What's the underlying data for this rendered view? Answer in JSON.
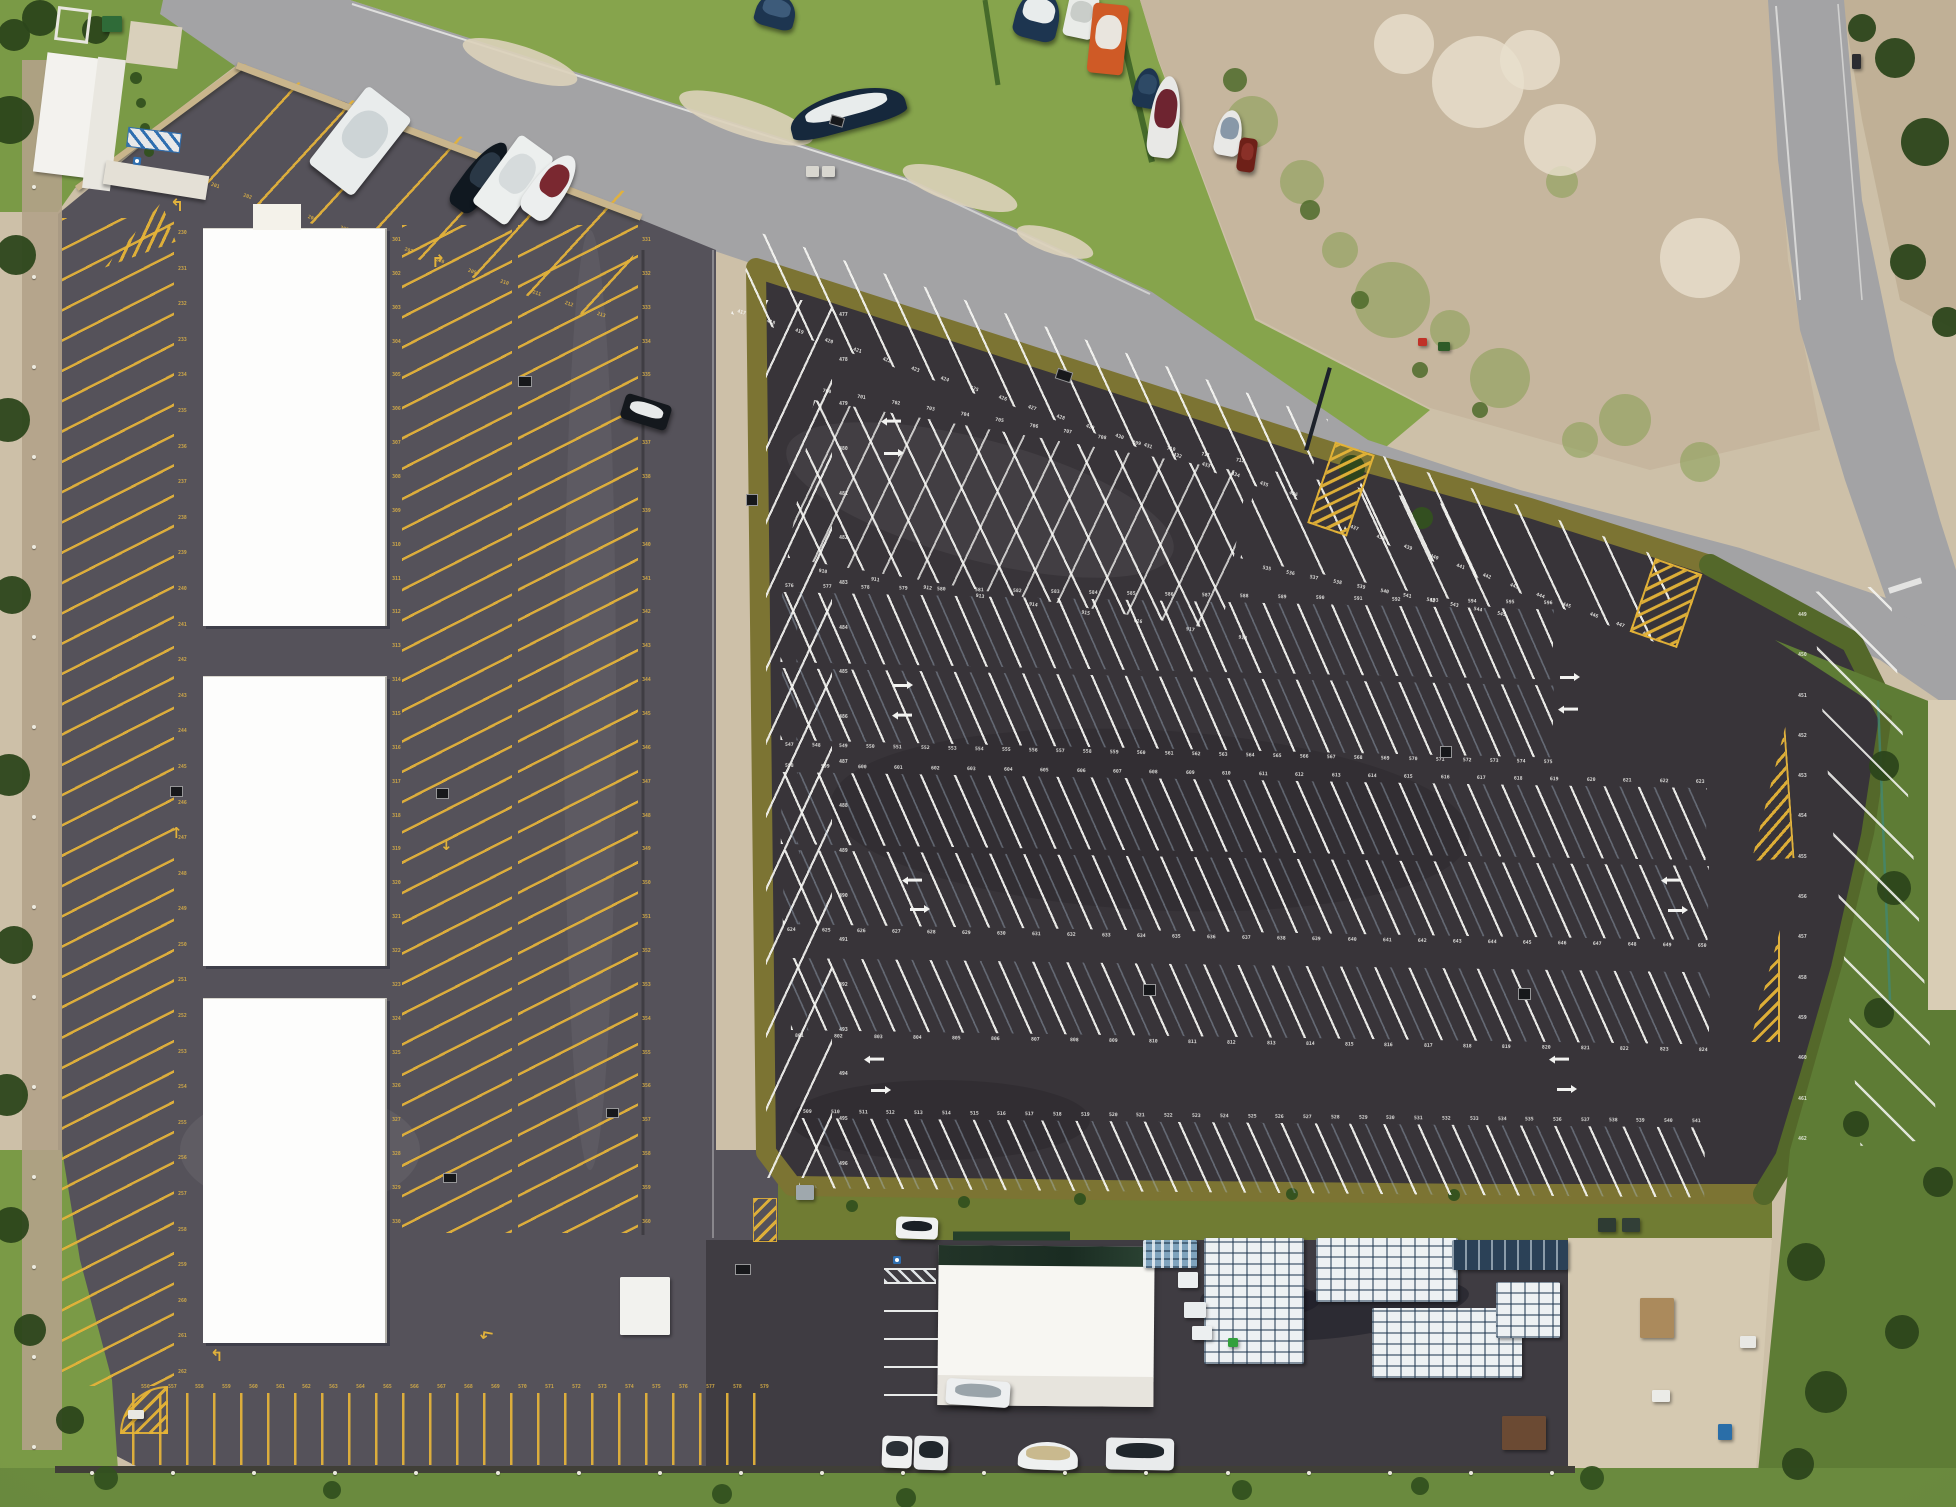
{
  "meta": {
    "title": "Aerial top-down drone photo of a marina parking complex",
    "width": 1956,
    "height": 1507,
    "scene": "New dark-asphalt trailer parking lot with white numbered stalls, older gray lot with yellow stalls and three white storage canopies, access roads, boat yard, dirt lot, warehouse with pallet yard"
  },
  "palette": {
    "sand": "#cdc0a8",
    "dirt": "#c6b69e",
    "road": "#a3a3a5",
    "left_lot": "#55525a",
    "main_lot": "#383439",
    "yard": "#3f3c42",
    "berm_olive": "#7c7433",
    "berm_green": "#54682a",
    "grass": "#7a9a46",
    "grass_dark": "#5e7c35",
    "yellow_paint": "#e3b23c",
    "white_paint": "#f2f2f0",
    "canopy_white": "#fdfdfc",
    "wall_tan": "#c9b58c",
    "blue_paint": "#2f6fb0"
  },
  "space_numbers": {
    "rv_spaces": {
      "start": 201,
      "end": 213
    },
    "left_col1": {
      "start": 230,
      "end": 262
    },
    "left_col2": {
      "start": 301,
      "end": 330
    },
    "left_col3": {
      "start": 331,
      "end": 360
    },
    "bottom_drive": {
      "start": 556,
      "end": 579
    },
    "top_edge": {
      "start": 417,
      "end": 436
    },
    "top_edge_right": {
      "start": 437,
      "end": 448
    },
    "left_col_main": {
      "start": 477,
      "end": 496
    },
    "right_col_main": {
      "start": 449,
      "end": 462
    },
    "cross_upper": {
      "start": 700,
      "end": 712
    },
    "cross_lower": {
      "start": 910,
      "end": 918
    },
    "rowA": {
      "start": 535,
      "end": 545
    },
    "r1_top": {
      "start": 576,
      "end": 596
    },
    "r1_bottom": {
      "start": 547,
      "end": 575
    },
    "r2_top": {
      "start": 598,
      "end": 623
    },
    "r2_bottom": {
      "start": 624,
      "end": 650
    },
    "r3_bottom": {
      "start": 801,
      "end": 824
    },
    "r4_top": {
      "start": 509,
      "end": 541
    }
  },
  "markings": {
    "white_arrows": [
      [
        886,
        420,
        180
      ],
      [
        884,
        452,
        0
      ],
      [
        893,
        684,
        0
      ],
      [
        897,
        714,
        180
      ],
      [
        907,
        879,
        180
      ],
      [
        910,
        908,
        0
      ],
      [
        869,
        1058,
        180
      ],
      [
        871,
        1089,
        0
      ],
      [
        1560,
        676,
        0
      ],
      [
        1563,
        708,
        180
      ],
      [
        1666,
        879,
        180
      ],
      [
        1668,
        909,
        0
      ],
      [
        1554,
        1058,
        180
      ],
      [
        1557,
        1088,
        0
      ]
    ],
    "yellow_arrows": [
      [
        170,
        196,
        "↰",
        0,
        17
      ],
      [
        431,
        252,
        "↱",
        0,
        17
      ],
      [
        170,
        824,
        "↑",
        0,
        15
      ],
      [
        440,
        836,
        "↓",
        0,
        15
      ],
      [
        210,
        1346,
        "↰",
        0,
        16
      ],
      [
        480,
        1326,
        "↰",
        -80,
        16
      ]
    ]
  },
  "objects": {
    "vehicles": [
      {
        "x": 756,
        "y": -6,
        "w": 40,
        "h": 34,
        "r": 15,
        "c1": "#1d3550",
        "c2": "#3d5b7a",
        "n": "boat"
      },
      {
        "x": 788,
        "y": 92,
        "w": 118,
        "h": 38,
        "r": -15,
        "c1": "#16283c",
        "c2": "#e8ecec",
        "n": "boat"
      },
      {
        "x": 1016,
        "y": -10,
        "w": 44,
        "h": 50,
        "r": 14,
        "c1": "#1d3550",
        "c2": "#e8ecec",
        "n": "boat"
      },
      {
        "x": 1066,
        "y": -6,
        "w": 30,
        "h": 44,
        "r": 12,
        "c1": "#e9ebe8",
        "c2": "#c9cdc9",
        "n": "camper"
      },
      {
        "x": 1090,
        "y": 4,
        "w": 36,
        "h": 70,
        "r": 6,
        "c1": "#cf5a26",
        "c2": "#e9e5de",
        "n": "truck-orange"
      },
      {
        "x": 1134,
        "y": 68,
        "w": 26,
        "h": 40,
        "r": 10,
        "c1": "#1d3550",
        "c2": "#2e4a66",
        "n": "boat"
      },
      {
        "x": 1150,
        "y": 76,
        "w": 30,
        "h": 82,
        "r": 7,
        "c1": "#e8e8e6",
        "c2": "#6e2430",
        "n": "boat-maroon"
      },
      {
        "x": 1216,
        "y": 110,
        "w": 26,
        "h": 46,
        "r": 10,
        "c1": "#e8e8e6",
        "c2": "#8898a8",
        "n": "boat"
      },
      {
        "x": 1238,
        "y": 138,
        "w": 18,
        "h": 34,
        "r": 8,
        "c1": "#6e2018",
        "c2": "#8a3028",
        "n": "car-red"
      },
      {
        "x": 332,
        "y": 92,
        "w": 56,
        "h": 98,
        "r": 38,
        "c1": "#e9ecec",
        "c2": "#cdd4d6",
        "n": "rv-bus"
      },
      {
        "x": 466,
        "y": 136,
        "w": 30,
        "h": 80,
        "r": 36,
        "c1": "#101820",
        "c2": "#2a3846",
        "n": "boat-black"
      },
      {
        "x": 492,
        "y": 138,
        "w": 42,
        "h": 84,
        "r": 36,
        "c1": "#ecefee",
        "c2": "#d6dbdc",
        "n": "rv"
      },
      {
        "x": 534,
        "y": 150,
        "w": 34,
        "h": 72,
        "r": 36,
        "c1": "#eceeee",
        "c2": "#7a2830",
        "n": "boat-maroon"
      },
      {
        "x": 622,
        "y": 399,
        "w": 48,
        "h": 26,
        "r": 17,
        "c1": "#14181d",
        "c2": "#e8eaea",
        "n": "car-black"
      },
      {
        "x": 896,
        "y": 1217,
        "w": 42,
        "h": 22,
        "r": 2,
        "c1": "#eff1f1",
        "c2": "#1a2026",
        "n": "car-white"
      },
      {
        "x": 946,
        "y": 1380,
        "w": 64,
        "h": 26,
        "r": 4,
        "c1": "#edeff0",
        "c2": "#9aa4aa",
        "n": "truck-trailer"
      },
      {
        "x": 882,
        "y": 1436,
        "w": 30,
        "h": 32,
        "r": 2,
        "c1": "#eef0f0",
        "c2": "#2a3036",
        "n": "car-white"
      },
      {
        "x": 914,
        "y": 1436,
        "w": 34,
        "h": 34,
        "r": 2,
        "c1": "#e9ebec",
        "c2": "#20262c",
        "n": "car-white"
      },
      {
        "x": 1018,
        "y": 1442,
        "w": 60,
        "h": 28,
        "r": 2,
        "c1": "#eef0f0",
        "c2": "#c9b98e",
        "n": "truck-boat"
      },
      {
        "x": 1106,
        "y": 1438,
        "w": 68,
        "h": 32,
        "r": 1,
        "c1": "#e9ebec",
        "c2": "#20262c",
        "n": "truck-trailer-dark"
      }
    ],
    "pallet_clusters": [
      {
        "x": 1143,
        "y": 1240,
        "w": 54,
        "h": 28,
        "t": "blue"
      },
      {
        "x": 1204,
        "y": 1238,
        "w": 100,
        "h": 126,
        "t": "w"
      },
      {
        "x": 1316,
        "y": 1238,
        "w": 142,
        "h": 64,
        "t": "w"
      },
      {
        "x": 1372,
        "y": 1308,
        "w": 150,
        "h": 70,
        "t": "w"
      },
      {
        "x": 1452,
        "y": 1240,
        "w": 116,
        "h": 30,
        "t": "navy"
      },
      {
        "x": 1496,
        "y": 1282,
        "w": 64,
        "h": 56,
        "t": "w"
      }
    ],
    "dark_squares": [
      [
        830,
        116,
        14,
        10,
        16
      ],
      [
        1056,
        370,
        16,
        11,
        18
      ],
      [
        746,
        494,
        12,
        12,
        0
      ],
      [
        518,
        376,
        14,
        11,
        0
      ],
      [
        1440,
        746,
        12,
        12,
        0
      ],
      [
        1143,
        984,
        13,
        12,
        0
      ],
      [
        1518,
        988,
        13,
        12,
        0
      ],
      [
        735,
        1264,
        16,
        11,
        0
      ],
      [
        443,
        1173,
        14,
        10,
        0
      ],
      [
        606,
        1108,
        13,
        10,
        0
      ],
      [
        170,
        786,
        13,
        11,
        0
      ],
      [
        436,
        788,
        13,
        11,
        0
      ]
    ],
    "boxes": [
      {
        "x": 620,
        "y": 1277,
        "w": 50,
        "h": 58,
        "c": "#f2f2ee",
        "n": "shed-white"
      },
      {
        "x": 1502,
        "y": 1416,
        "w": 44,
        "h": 34,
        "c": "#6b4a33",
        "n": "shed-brown"
      },
      {
        "x": 796,
        "y": 1185,
        "w": 18,
        "h": 15,
        "c": "#9fa8ad",
        "n": "shed-gray"
      },
      {
        "x": 102,
        "y": 16,
        "w": 20,
        "h": 16,
        "c": "#2f6b38",
        "n": "shed-green"
      },
      {
        "x": 1178,
        "y": 1272,
        "w": 20,
        "h": 16,
        "c": "#eceff0",
        "n": "dumpster"
      },
      {
        "x": 1184,
        "y": 1302,
        "w": 22,
        "h": 16,
        "c": "#e9edee",
        "n": "dumpster"
      },
      {
        "x": 1192,
        "y": 1326,
        "w": 20,
        "h": 14,
        "c": "#eceff0",
        "n": "dumpster"
      },
      {
        "x": 1640,
        "y": 1298,
        "w": 34,
        "h": 40,
        "c": "#ab8a5c",
        "n": "crates"
      },
      {
        "x": 1652,
        "y": 1390,
        "w": 18,
        "h": 12,
        "c": "#ebebe7",
        "n": "pallet"
      },
      {
        "x": 1740,
        "y": 1336,
        "w": 16,
        "h": 12,
        "c": "#e8e8e4",
        "n": "pallet"
      },
      {
        "x": 1718,
        "y": 1424,
        "w": 14,
        "h": 16,
        "c": "#2a6ea8",
        "n": "bin-blue"
      },
      {
        "x": 1598,
        "y": 1218,
        "w": 18,
        "h": 14,
        "c": "#2e3b33",
        "n": "bin-dark"
      },
      {
        "x": 1622,
        "y": 1218,
        "w": 18,
        "h": 14,
        "c": "#323f37",
        "n": "bin-dark"
      },
      {
        "x": 1852,
        "y": 54,
        "w": 9,
        "h": 15,
        "c": "#2c2c30",
        "n": "road-sign"
      },
      {
        "x": 806,
        "y": 166,
        "w": 13,
        "h": 11,
        "c": "#d8d6cf",
        "n": "utility-box"
      },
      {
        "x": 822,
        "y": 166,
        "w": 13,
        "h": 11,
        "c": "#d8d6cf",
        "n": "utility-box"
      },
      {
        "x": 1228,
        "y": 1338,
        "w": 10,
        "h": 9,
        "c": "#33a03c",
        "n": "equipment-green"
      },
      {
        "x": 1418,
        "y": 338,
        "w": 9,
        "h": 8,
        "c": "#c03228",
        "n": "equipment-red"
      },
      {
        "x": 1438,
        "y": 342,
        "w": 12,
        "h": 9,
        "c": "#2e5c28",
        "n": "equipment"
      },
      {
        "x": 128,
        "y": 1410,
        "w": 16,
        "h": 9,
        "c": "#e8e8e2",
        "n": "fallen-sign"
      }
    ],
    "fences": {
      "left": {
        "x": 32,
        "y0": 185,
        "y1": 1445,
        "n": 15
      },
      "bottom": {
        "y": 1471,
        "x0": 90,
        "x1": 1550,
        "n": 19
      }
    },
    "trees": [
      [
        10,
        120,
        24
      ],
      [
        16,
        255,
        20
      ],
      [
        8,
        420,
        22
      ],
      [
        12,
        595,
        19
      ],
      [
        9,
        775,
        21
      ],
      [
        14,
        945,
        19
      ],
      [
        7,
        1095,
        21
      ],
      [
        11,
        1225,
        18
      ],
      [
        30,
        1330,
        16
      ],
      [
        70,
        1420,
        14
      ],
      [
        40,
        18,
        18
      ],
      [
        96,
        30,
        14
      ],
      [
        152,
        54,
        11
      ],
      [
        14,
        35,
        16
      ],
      [
        1352,
        468,
        13
      ],
      [
        1422,
        518,
        11
      ],
      [
        1884,
        766,
        15
      ],
      [
        1894,
        888,
        17
      ],
      [
        1879,
        1013,
        15
      ],
      [
        1856,
        1124,
        13
      ],
      [
        1806,
        1262,
        19
      ],
      [
        1826,
        1392,
        21
      ],
      [
        1902,
        1332,
        17
      ],
      [
        1938,
        1182,
        15
      ],
      [
        1798,
        1464,
        16
      ],
      [
        1895,
        58,
        20
      ],
      [
        1925,
        142,
        24
      ],
      [
        1908,
        262,
        18
      ],
      [
        1947,
        322,
        15
      ],
      [
        1862,
        28,
        14
      ],
      [
        106,
        1478,
        12
      ],
      [
        332,
        1490,
        9
      ],
      [
        722,
        1494,
        10
      ],
      [
        906,
        1498,
        10
      ],
      [
        1242,
        1490,
        10
      ],
      [
        1420,
        1486,
        9
      ],
      [
        1592,
        1478,
        12
      ],
      [
        852,
        1206,
        6
      ],
      [
        964,
        1202,
        6
      ],
      [
        1080,
        1199,
        6
      ],
      [
        1292,
        1194,
        6
      ],
      [
        1454,
        1195,
        6
      ],
      [
        136,
        78,
        6
      ],
      [
        141,
        103,
        5
      ],
      [
        145,
        128,
        5
      ],
      [
        149,
        152,
        5
      ]
    ],
    "green_speckles": [
      [
        1392,
        300,
        38
      ],
      [
        1500,
        378,
        30
      ],
      [
        1625,
        420,
        26
      ],
      [
        1302,
        182,
        22
      ],
      [
        1700,
        462,
        20
      ],
      [
        1562,
        182,
        16
      ],
      [
        1252,
        122,
        26
      ],
      [
        1450,
        330,
        20
      ],
      [
        1340,
        250,
        18
      ],
      [
        1580,
        440,
        18
      ]
    ],
    "shrubs": [
      [
        1310,
        210,
        10
      ],
      [
        1360,
        300,
        9
      ],
      [
        1420,
        370,
        8
      ],
      [
        1480,
        410,
        8
      ],
      [
        1235,
        80,
        12
      ]
    ],
    "bright_sand": [
      [
        1478,
        82,
        46
      ],
      [
        1560,
        140,
        36
      ],
      [
        1700,
        258,
        40
      ],
      [
        1404,
        44,
        30
      ],
      [
        1530,
        60,
        30
      ]
    ],
    "yard_sand": [
      [
        520,
        62,
        60,
        16
      ],
      [
        746,
        118,
        70,
        18
      ],
      [
        960,
        188,
        60,
        16
      ],
      [
        1055,
        242,
        40,
        12
      ]
    ]
  }
}
